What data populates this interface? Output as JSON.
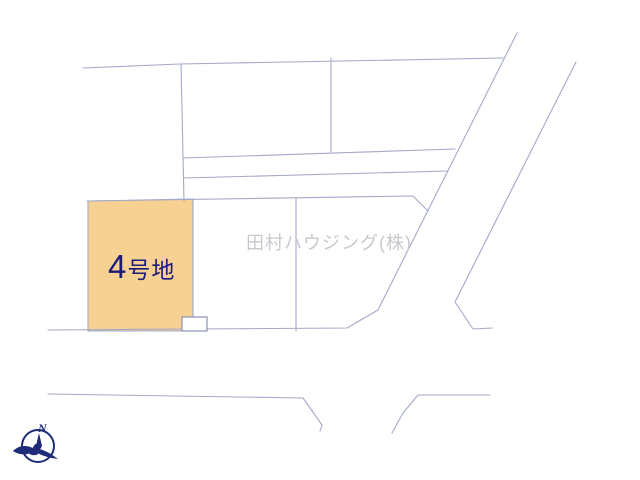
{
  "labels": {
    "highlighted_lot": "4号地",
    "watermark": "田村ハウジング(株)",
    "compass_north": "N"
  },
  "colors": {
    "plot_line": "#a3a9c9",
    "notch_border": "#8a92b5",
    "highlight_fill": "#f6d191",
    "lot_label_text": "#1b1b78",
    "watermark_text": "#c8c8ce",
    "compass": "#1d2b7a",
    "background": "#ffffff"
  },
  "diagram": {
    "highlight_polygon": "88,201 193,199 193,331 88,331",
    "notch_rect": {
      "x": 182,
      "y": 317,
      "w": 25,
      "h": 14
    },
    "lines": [
      {
        "name": "boundary-top-line",
        "points": "83,68 180,64 503,58"
      },
      {
        "name": "divider-left-vertical",
        "points": "181,64 184,201"
      },
      {
        "name": "divider-upper-vertical",
        "points": "331,58 331,152"
      },
      {
        "name": "strip-line-upper",
        "points": "183,158 455,149"
      },
      {
        "name": "strip-line-lower",
        "points": "184,178 448,171"
      },
      {
        "name": "lot-row-top-line",
        "points": "87,201 413,196 428,211"
      },
      {
        "name": "road-left-edge",
        "points": "517,33 378,310 347,328 48,330"
      },
      {
        "name": "road-right-edge",
        "points": "576,62 455,302 473,329 492,328"
      },
      {
        "name": "lot4-right-divider",
        "points": "193,200 193,317"
      },
      {
        "name": "lot-row-middle-divider",
        "points": "296,198 296,331"
      },
      {
        "name": "road-bottom-edge-left",
        "points": "48,394 303,398 322,425 320,431"
      },
      {
        "name": "road-bottom-edge-right",
        "points": "490,395 418,395 403,413 392,433"
      }
    ]
  }
}
